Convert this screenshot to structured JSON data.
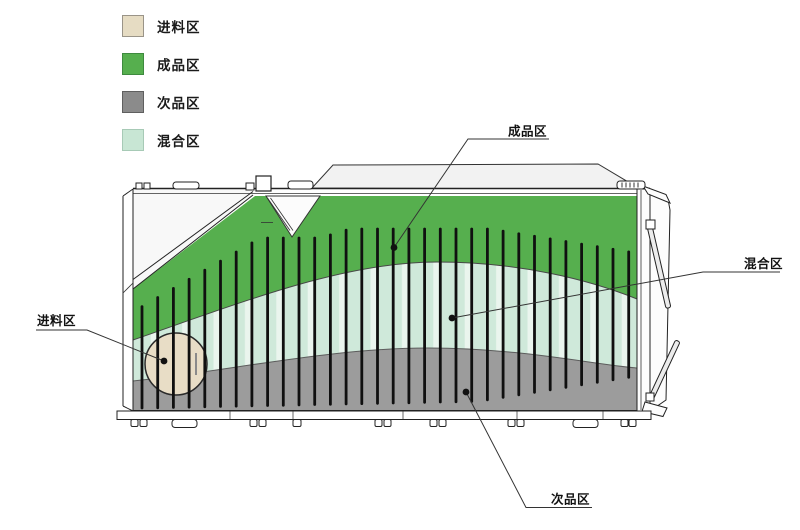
{
  "legend": {
    "items": [
      {
        "id": "feed",
        "label": "进料区",
        "color": "#e6dcc3",
        "border": "#9a9488"
      },
      {
        "id": "finished",
        "label": "成品区",
        "color": "#56af4e",
        "border": "#3e8a3e"
      },
      {
        "id": "defective",
        "label": "次品区",
        "color": "#8b8b8b",
        "border": "#5f5f5f"
      },
      {
        "id": "mixed",
        "label": "混合区",
        "color": "#c8e6d4",
        "border": "#a7cab6"
      }
    ]
  },
  "callouts": {
    "finished": {
      "label": "成品区"
    },
    "mixed": {
      "label": "混合区"
    },
    "feed": {
      "label": "进料区"
    },
    "defective": {
      "label": "次品区"
    }
  },
  "colors": {
    "feed_zone": "#e8ddc6",
    "finished_zone": "#56af4e",
    "defective_zone": "#9c9c9c",
    "mixed_zone": "#cfe9da",
    "mixed_zone_highlight": "#eaf5ee",
    "line": "#222222"
  },
  "figure": {
    "grate_bar_count": 32
  }
}
